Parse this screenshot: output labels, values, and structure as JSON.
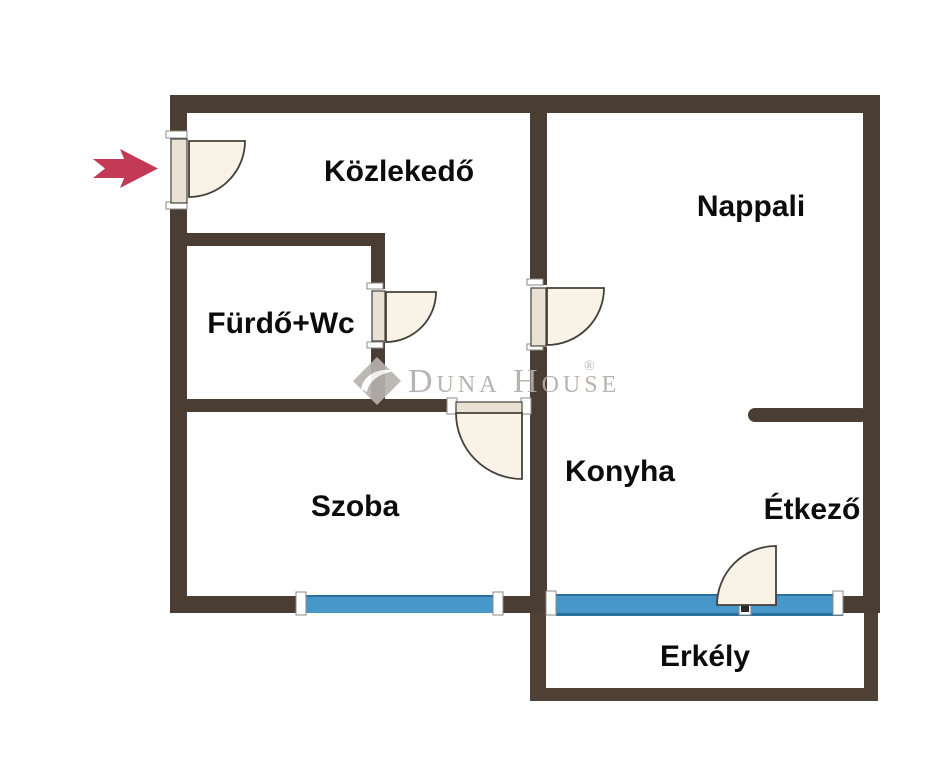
{
  "floorplan": {
    "rooms": [
      {
        "id": "kozlekedo",
        "label": "Közlekedő"
      },
      {
        "id": "nappali",
        "label": "Nappali"
      },
      {
        "id": "furdo-wc",
        "label": "Fürdő+Wc"
      },
      {
        "id": "szoba",
        "label": "Szoba"
      },
      {
        "id": "konyha",
        "label": "Konyha"
      },
      {
        "id": "etkezo",
        "label": "Étkező"
      },
      {
        "id": "erkely",
        "label": "Erkély"
      }
    ],
    "watermark": {
      "brand": "Duna House",
      "registered_mark": "®"
    },
    "entrance": {
      "arrow_direction": "right"
    },
    "colors": {
      "wall": "#4a3e34",
      "window_blue": "#4798c8",
      "door_fill": "#f8f2e7",
      "door_panel": "#e8e1d4",
      "arrow_red": "#c33a56",
      "watermark_gray": "#b2adaa",
      "label_black": "#0c0c0c",
      "background": "#ffffff"
    }
  }
}
